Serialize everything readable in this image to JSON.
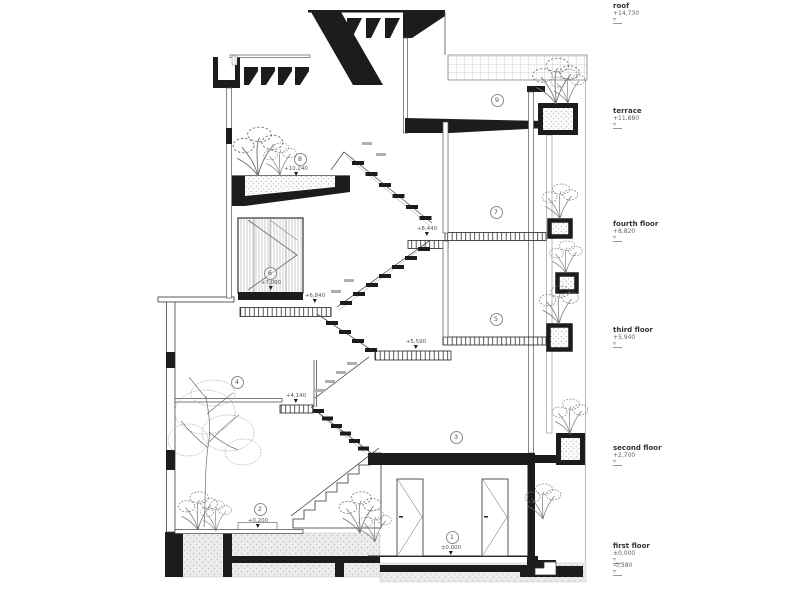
{
  "drawing": {
    "type": "architectural-building-section",
    "floor_labels": [
      {
        "name": "roof",
        "elevation": "+14,730"
      },
      {
        "name": "terrace",
        "elevation": "+11,880"
      },
      {
        "name": "fourth floor",
        "elevation": "+8,820"
      },
      {
        "name": "third floor",
        "elevation": "+5,940"
      },
      {
        "name": "second floor",
        "elevation": "+2,700"
      },
      {
        "name": "first floor",
        "elevation": "±0,000"
      },
      {
        "name": "",
        "elevation": "-0,380"
      }
    ],
    "level_annotations": [
      {
        "value": "+10,240"
      },
      {
        "value": "+8,440"
      },
      {
        "value": "+7,090"
      },
      {
        "value": "+6,840"
      },
      {
        "value": "+5,590"
      },
      {
        "value": "+4,140"
      },
      {
        "value": "+0,200"
      },
      {
        "value": "±0.000"
      }
    ],
    "room_numbers": [
      {
        "number": "1"
      },
      {
        "number": "2"
      },
      {
        "number": "3"
      },
      {
        "number": "4"
      },
      {
        "number": "5"
      },
      {
        "number": "6"
      },
      {
        "number": "7"
      },
      {
        "number": "8"
      },
      {
        "number": "9"
      }
    ],
    "colors": {
      "line": "#3a3a3a",
      "cut_fill": "#1c1c1c",
      "ground_dots": "#bdbdbd"
    }
  }
}
